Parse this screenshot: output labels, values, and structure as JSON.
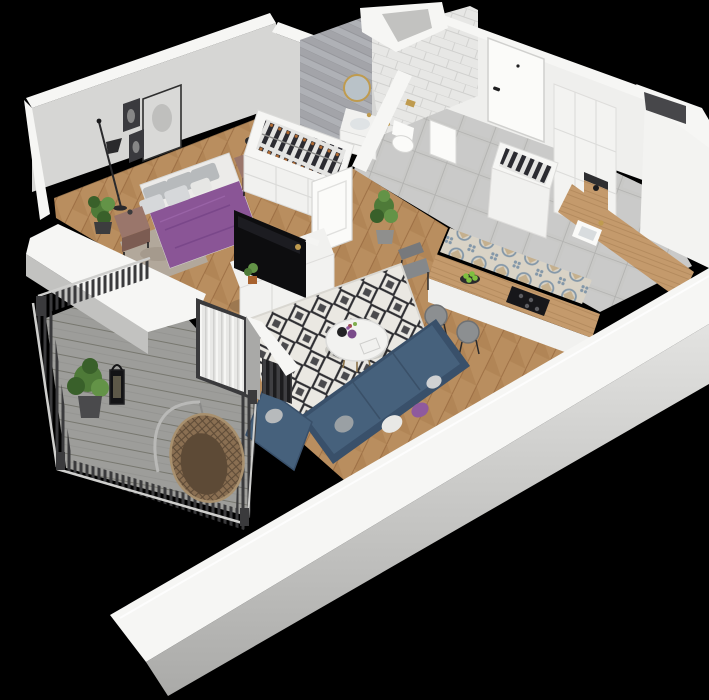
{
  "scene": {
    "kind": "3d-isometric-apartment-floorplan-render",
    "width_px": 709,
    "height_px": 700
  },
  "colors": {
    "background": "#000000",
    "wall_top": "#f6f6f4",
    "wall_top_dim": "#ededeb",
    "wall_face_light": "#efefed",
    "wall_face_bright": "#f3f3f1",
    "wall_face_mid": "#d6d6d4",
    "wall_face_shadow": "#c2c2c0",
    "wall_outer_1": "#e3e3e1",
    "wall_outer_2": "#aaaaa8",
    "floor_wood": "#b98e5f",
    "floor_wood_dark": "#a67a4b",
    "floor_wood_line": "#8f6138",
    "hall_tile": "#c8c8c6",
    "hall_tile_grout": "#b0b0ae",
    "pattern_tile_bg": "#d9d3c6",
    "pattern_tile_blue": "#8397a8",
    "pattern_tile_tan": "#c0a87f",
    "herringbone_gray": "#a3a4a9",
    "herringbone_gray_light": "#b8b9be",
    "subway_tile": "#e7e7e5",
    "subway_line": "#d0d0ce",
    "deck": "#9d9d9a",
    "deck_gap": "#77776f",
    "rail_dark": "#3a3a3c",
    "rail_light": "#cfcfcd",
    "rug_bg": "#eae8e2",
    "rug_ink": "#2e2e32",
    "bedside_rug": "#b2a89b",
    "duvet_purple": "#8a5596",
    "duvet_fold": "#744184",
    "duvet_highlight": "#9c66aa",
    "pillow_gray": "#b7babc",
    "pillow_light": "#d6d8da",
    "sheet_white": "#ecebe9",
    "nightstand_brown": "#9a766b",
    "nightstand_brown_dark": "#7c5c52",
    "sofa_blue": "#46617c",
    "sofa_blue_dark": "#39506a",
    "pillow_purple": "#8f5a9e",
    "table_white": "#f2f2f0",
    "gold_brass": "#bf9b4f",
    "tv_black": "#0d0d0f",
    "tv_gloss": "#1e1e24",
    "console_white": "#f1f1ef",
    "counter_wood": "#c49a6c",
    "counter_wood_line": "#a87f52",
    "cooktop_black": "#17171a",
    "apple_green": "#7fbf3f",
    "plant_green": "#4e7a38",
    "plant_green_dark": "#39602a",
    "plant_green_light": "#639347",
    "clothes_dark": "#2b2b31",
    "hanger_orange": "#b06a32",
    "rattan": "#8a6f52",
    "rattan_dark": "#5d4a36",
    "rattan_rim": "#a8906e",
    "door_white": "#fbfbf9",
    "handle_black": "#1f1f21",
    "mirror_glass": "#b9c2c8",
    "stool_gray": "#8c8f91",
    "chair_gray": "#85888b",
    "curtain_white": "#e8e8e6",
    "curtain_shade": "#a9a9a7",
    "frame_dark": "#3a3a3e",
    "art_light": "#d9d9d7",
    "pot_terracotta": "#a8622e",
    "pot_dark": "#3c3c3e",
    "radiator_dark": "#1c1c1e",
    "radiator_mid": "#3f3f42",
    "shaft_dark": "#47474a"
  }
}
